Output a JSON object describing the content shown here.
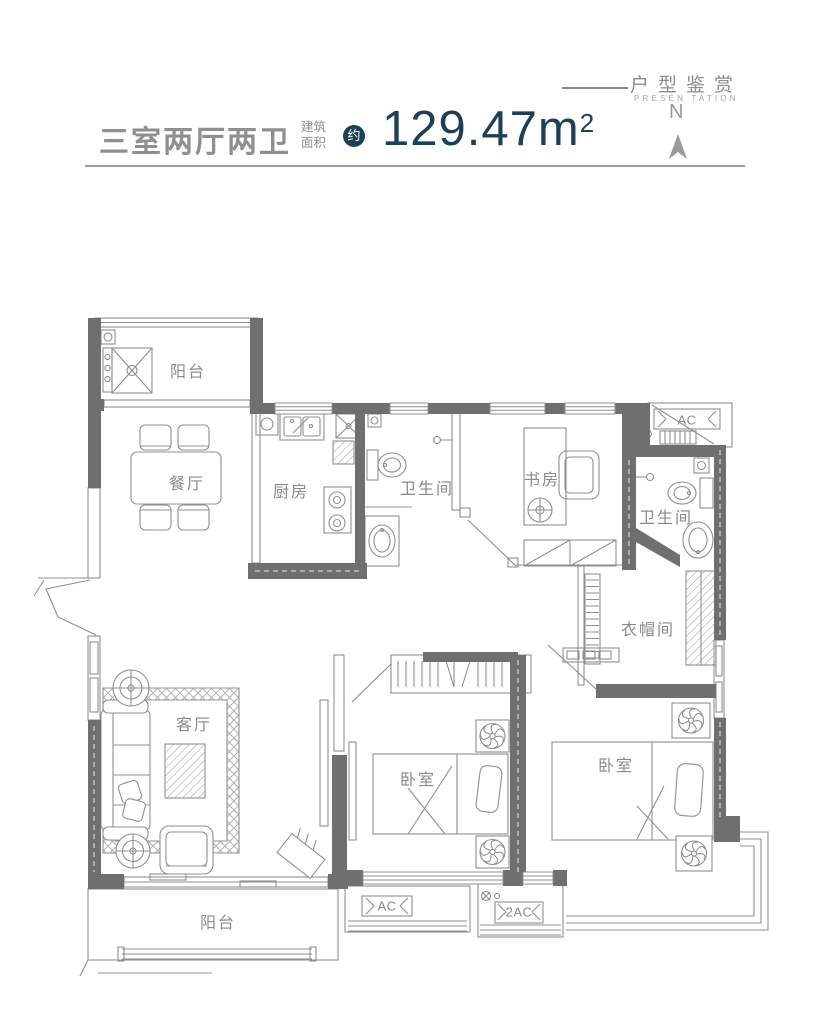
{
  "header": {
    "brand_cn": "户型鉴赏",
    "brand_en": "PRESEN TATION"
  },
  "title": {
    "layout_name": "三室两厅两卫",
    "area_label_top": "建筑",
    "area_label_bottom": "面积",
    "approx_badge": "约",
    "area_value": "129.47m",
    "area_exponent": "2",
    "compass_letter": "N"
  },
  "rooms": {
    "balcony_top": "阳台",
    "dining": "餐厅",
    "kitchen": "厨房",
    "bath1": "卫生间",
    "study": "书房",
    "bath2": "卫生间",
    "cloakroom": "衣帽间",
    "living": "客厅",
    "bedroom_mid": "卧室",
    "bedroom_right": "卧室",
    "balcony_bottom": "阳台"
  },
  "equipment": {
    "ac": "AC",
    "ac2": "2AC"
  },
  "colors": {
    "accent_navy": "#1d4055",
    "wall_gray": "#6f6f6f",
    "line_gray": "#8f8f8f",
    "text_gray": "#8a8a8a"
  }
}
